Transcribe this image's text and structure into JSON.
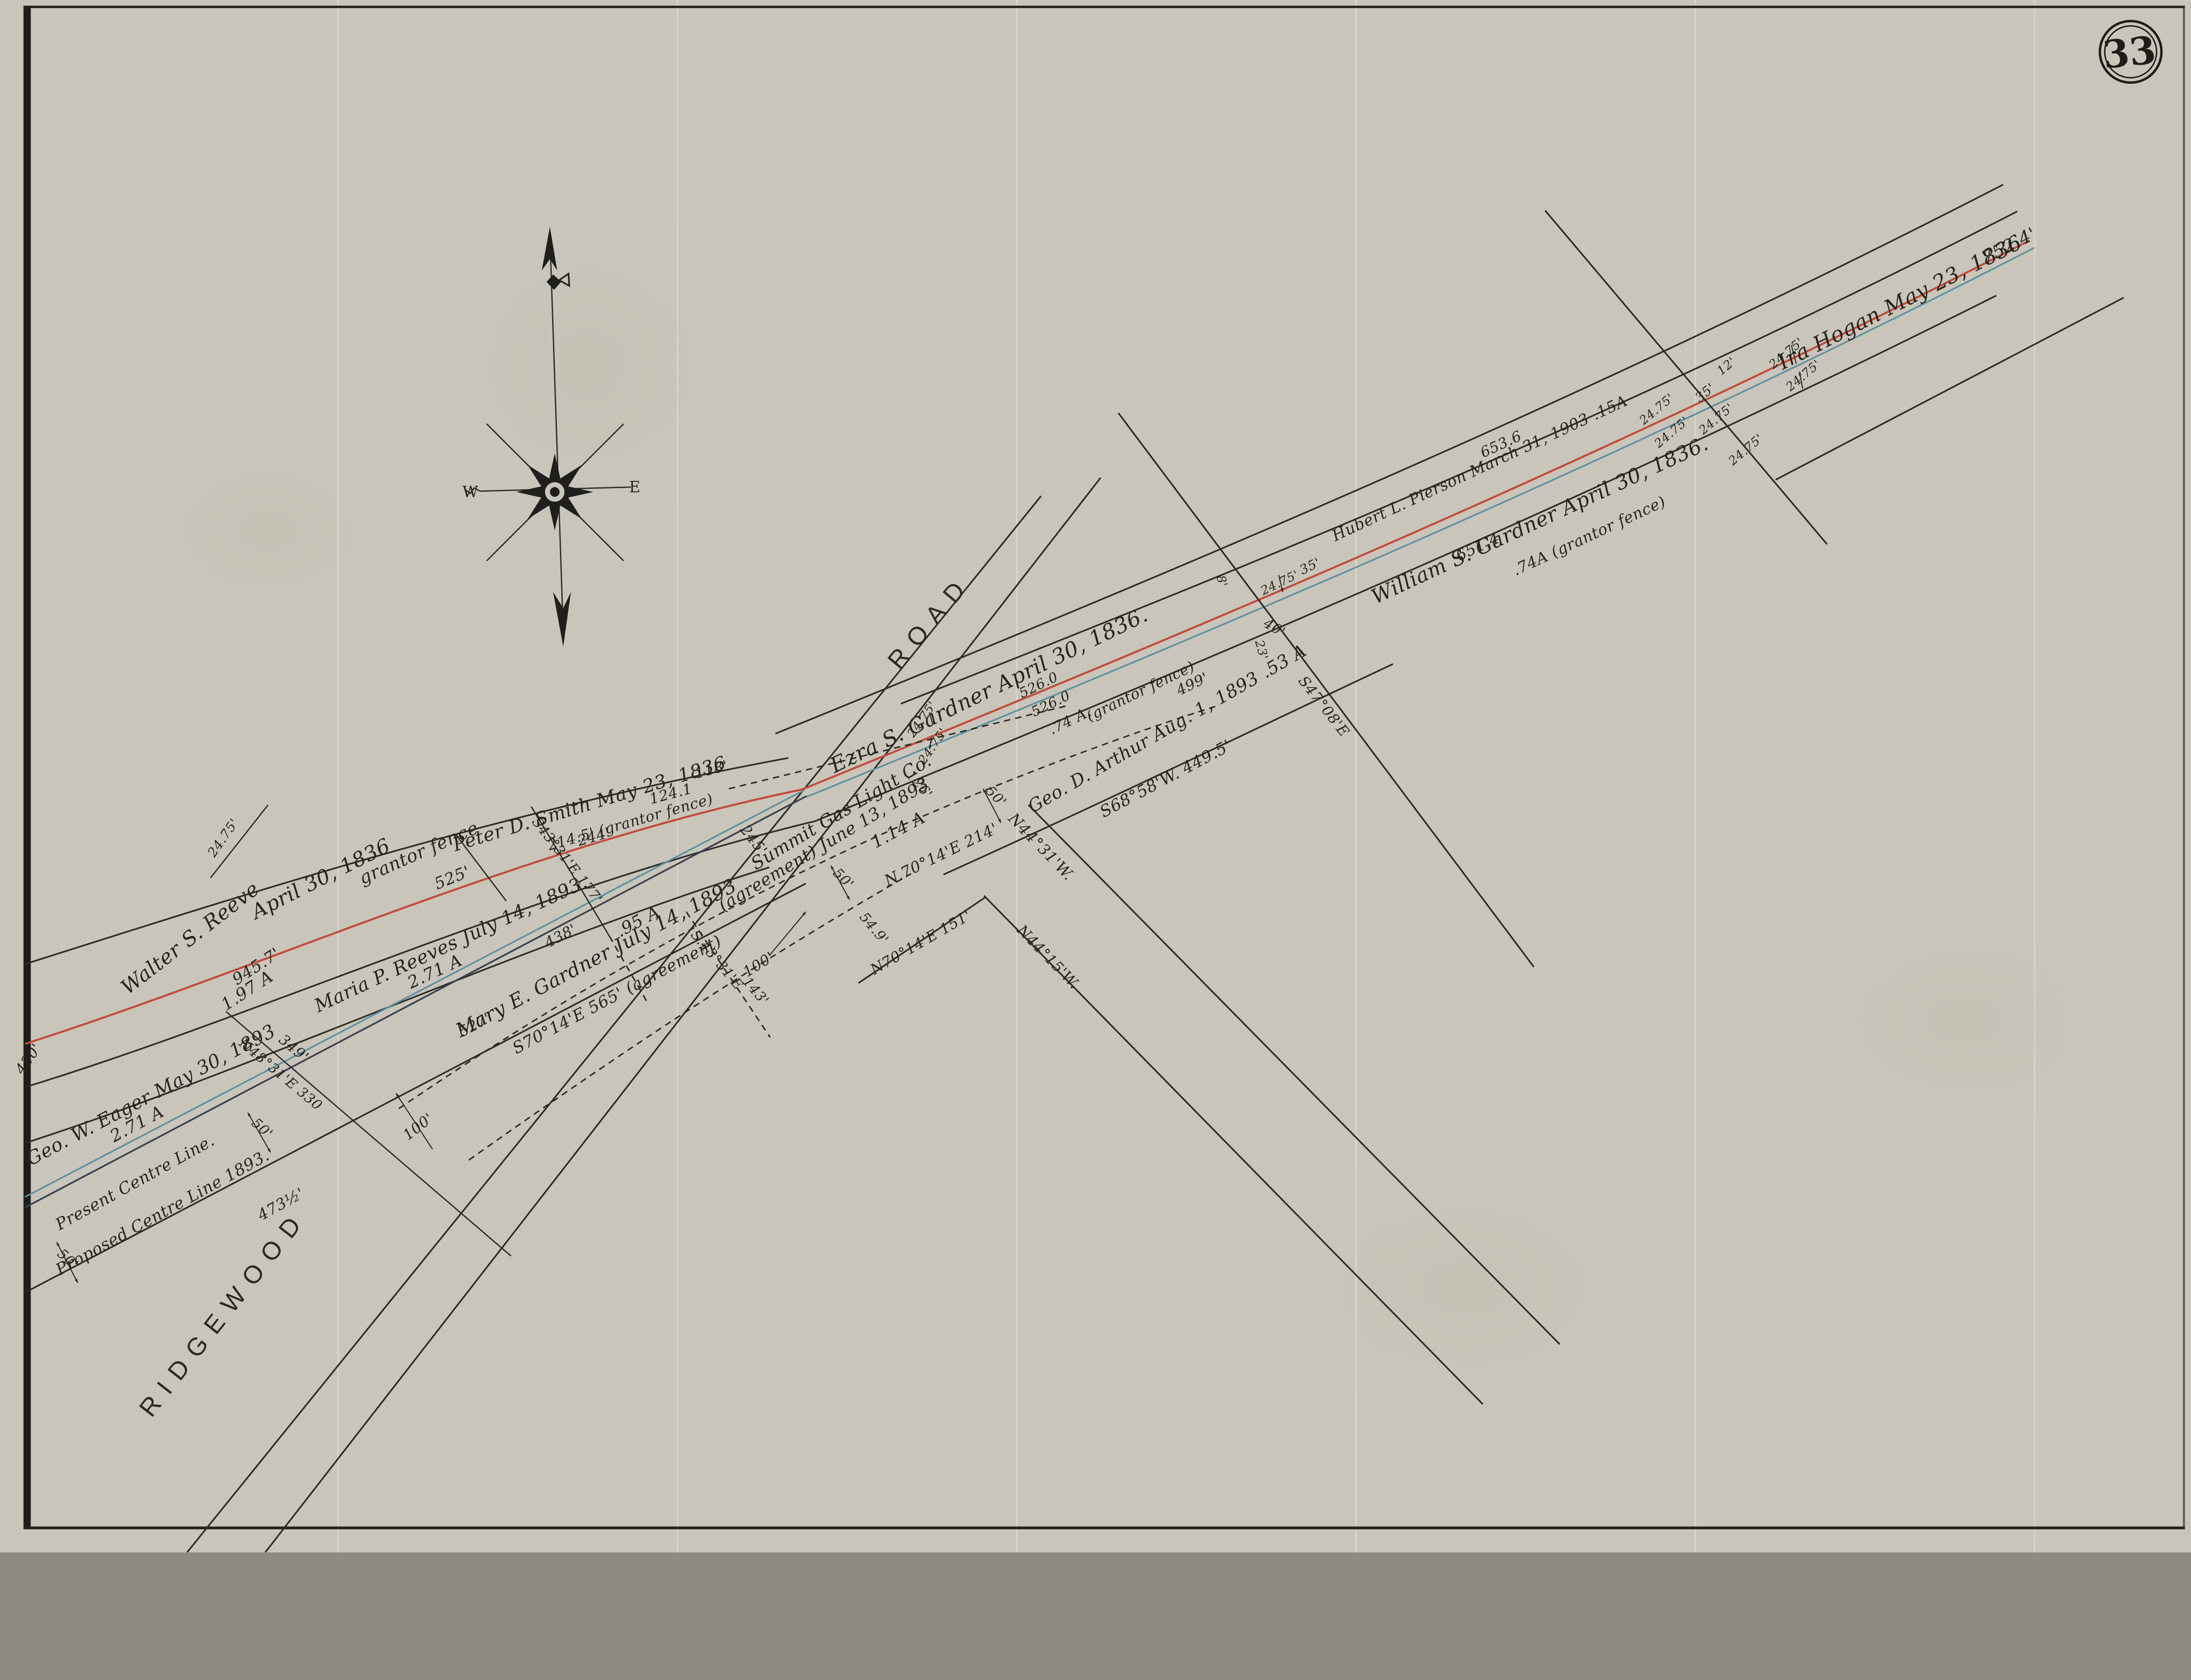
{
  "sheet": {
    "number": "33"
  },
  "compass": {
    "west": "W",
    "east": "E"
  },
  "labels": {
    "reeve_name": "Walter S. Reeve",
    "reeve_date": "April 30, 1836",
    "reeve_fence": "grantor fence",
    "reeve_len": "945.7'",
    "reeve_area": "1.97 A",
    "d_525": "525'",
    "smith_name": "Peter D. Smith  May 23, 1836",
    "smith_fence": "214.5' (grantor fence)",
    "d_244": "244'",
    "d_1241": "124.1",
    "d_118": "118'",
    "ezra_name": "Ezra S. Gardner  April 30, 1836.",
    "d_5260": "526.0",
    "ezra_area": ".74 A.",
    "ezra_fence": "(grantor fence)",
    "d_499": "499'",
    "arthur_name": "Geo. D. Arthur   Aug. 1, 1893   .53 A",
    "arthur_bearing": "S68°58'W.  449.5'",
    "d_126": "126'",
    "summit_name": "Summit Gas Light Co.",
    "summit_agree": "(agreement) June 13, 1893",
    "summit_area": "1.14 A",
    "b_n7014_214": "N.70°14'E  214'",
    "b_n4431": "N44°31'W.",
    "dim_50": "50'",
    "d_245": "245'",
    "d_549": "54.9'",
    "dim_100": "100'",
    "d_143": "143'",
    "b_s4331": "S.43°31'E",
    "b_n7014_151": "N70°14'E  151'",
    "b_n4415": "N44°15'W.",
    "b_s4331_177": "S43°31'E  177'",
    "mary_area": ".95 A",
    "mary_name": "Mary E. Gardner   July 14, 1893",
    "mary_bearing": "S70°14'E   565'  (agreement)",
    "d_438": "438'",
    "d_527": "527'",
    "maria_name": "Maria P. Reeves   July 14, 1893.",
    "area_271": "2.71 A",
    "eager_name": "Geo. W. Eager  May 30, 1893",
    "d_430": "430'",
    "d_349": "349'",
    "b_n4831": "N48°31'E  330",
    "present_line": "Present Centre Line.",
    "proposed_line": "Proposed Centre Line 1893.",
    "d_4735": "473½'",
    "ridgewood": "RIDGEWOOD",
    "road": "ROAD",
    "pierson_name": "Hubert L. Pierson   March 31, 1903   .15A",
    "d_6536": "653.6",
    "william_name": "William S. Gardner  April 30, 1836.",
    "d_6514": "651.4",
    "william_area": ".74A   (grantor fence)",
    "dim_2475": "24.75'",
    "dim_35": "35'",
    "dim_12": "12'",
    "b_s4708": "S47°08'E",
    "d_40": "40'",
    "d_23": "23'",
    "d_8": "8'",
    "hogan_name": "Ira Hogan   May 23, 1836",
    "d_7524": "752.4'"
  }
}
